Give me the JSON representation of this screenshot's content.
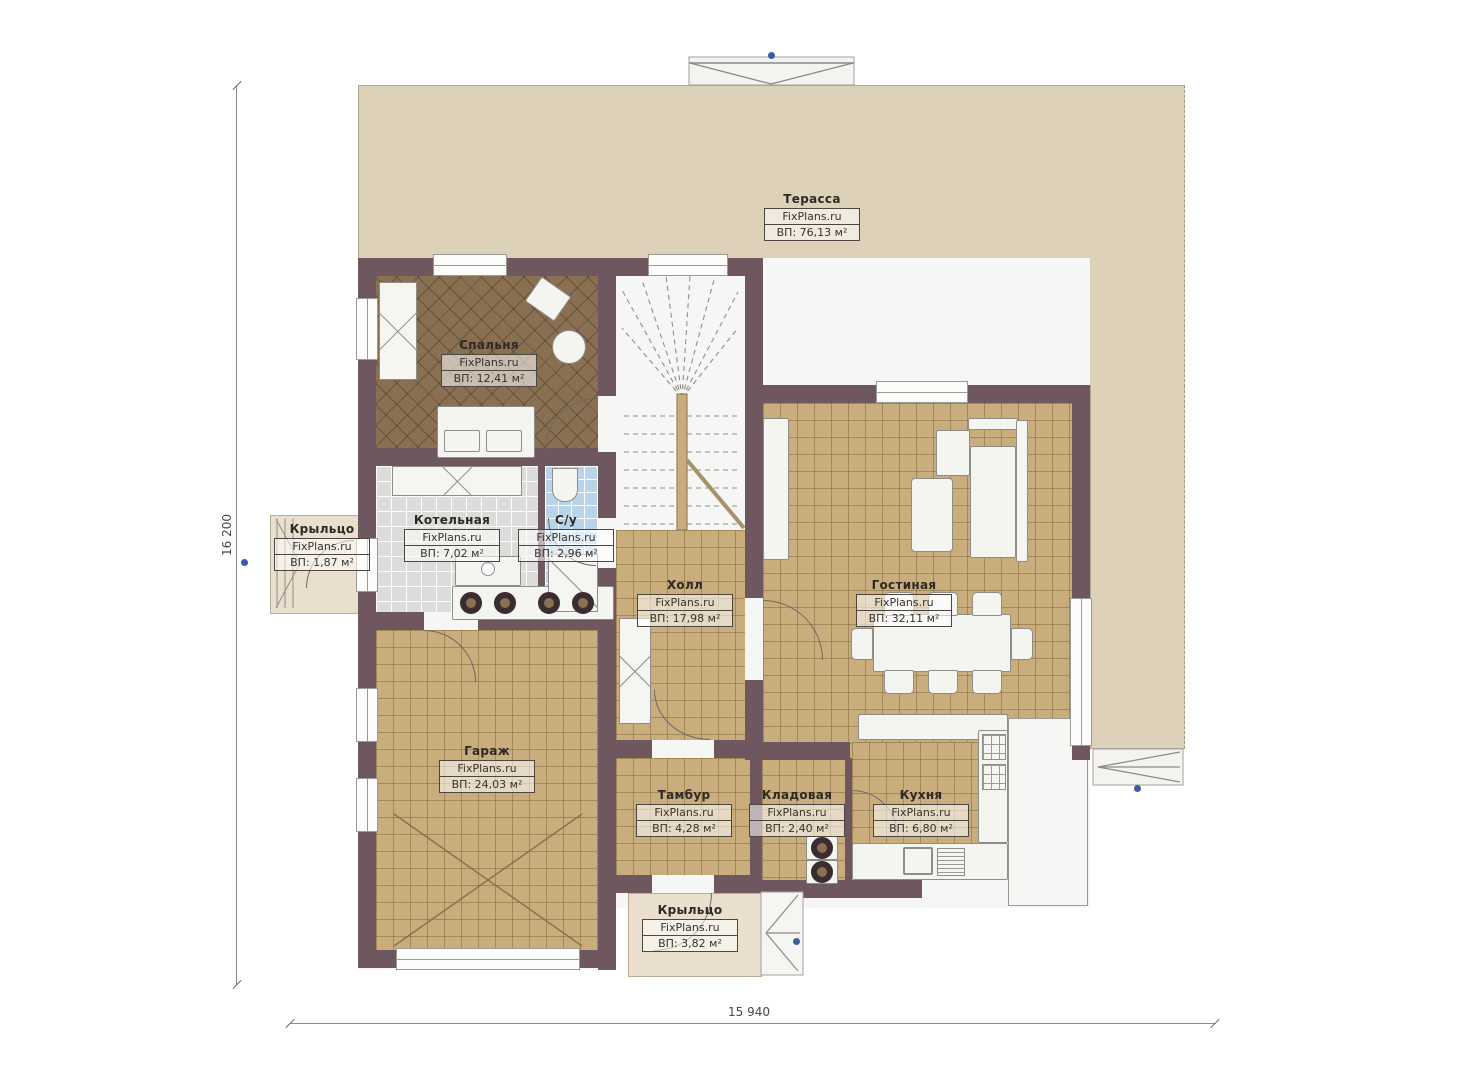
{
  "plan": {
    "watermark": "FixPlans.ru",
    "dimensions": {
      "height_mm": "16 200",
      "width_mm": "15 940"
    },
    "colors": {
      "wall": "#6f5760",
      "floor_tile": "#c9ad7c",
      "bedroom_floor": "#8a7053",
      "terrace": "#ddd1ba",
      "porch": "#e9dfcc",
      "boiler_tile": "#dcdcda",
      "bath_tile": "#b9d3e9",
      "marker_dot": "#3a5f9e"
    }
  },
  "rooms": [
    {
      "name": "Терасса",
      "area": "ВП: 76,13 м²"
    },
    {
      "name": "Спальня",
      "area": "ВП: 12,41 м²"
    },
    {
      "name": "Котельная",
      "area": "ВП: 7,02 м²"
    },
    {
      "name": "С/у",
      "area": "ВП: 2,96 м²"
    },
    {
      "name": "Холл",
      "area": "ВП: 17,98 м²"
    },
    {
      "name": "Гостиная",
      "area": "ВП: 32,11 м²"
    },
    {
      "name": "Гараж",
      "area": "ВП: 24,03 м²"
    },
    {
      "name": "Крыльцо",
      "area": "ВП: 1,87 м²"
    },
    {
      "name": "Тамбур",
      "area": "ВП: 4,28 м²"
    },
    {
      "name": "Кладовая",
      "area": "ВП: 2,40 м²"
    },
    {
      "name": "Кухня",
      "area": "ВП: 6,80 м²"
    },
    {
      "name": "Крыльцо",
      "area": "ВП: 3,82 м²"
    }
  ]
}
